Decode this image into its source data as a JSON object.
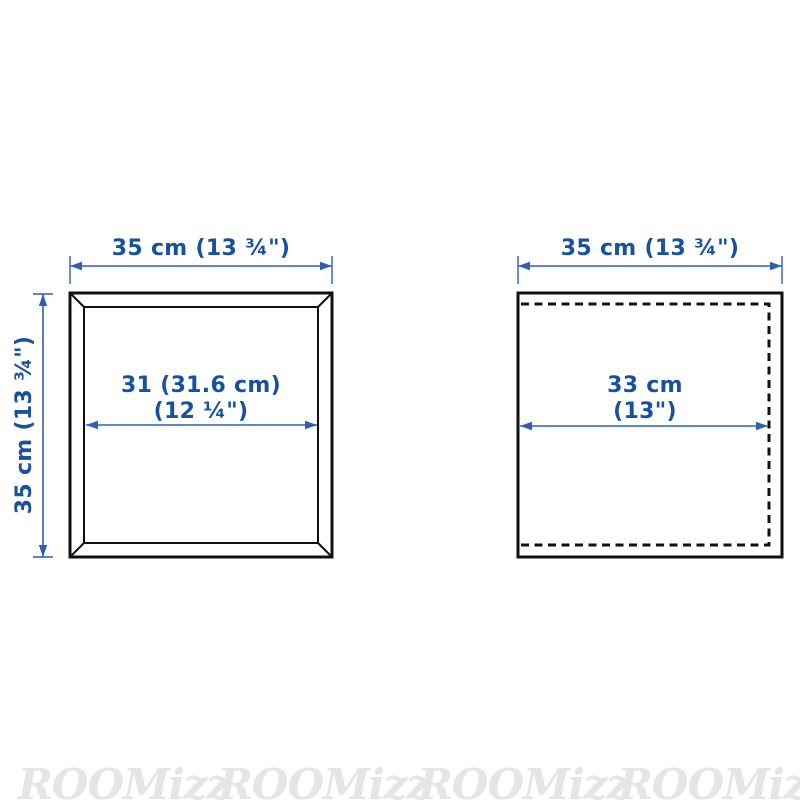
{
  "colors": {
    "dimension_text": "#17519f",
    "dimension_line": "#2f5fb3",
    "outline": "#111111",
    "watermark": "#e5e5e5"
  },
  "left_diagram": {
    "top_dimension": "35 cm (13 ¾\")",
    "height_dimension": "35 cm (13 ¾\")",
    "inner_width_line1": "31 (31.6 cm)",
    "inner_width_line2": "(12 ¼\")"
  },
  "right_diagram": {
    "top_dimension": "35 cm (13 ¾\")",
    "inner_width_line1": "33 cm",
    "inner_width_line2": "(13\")"
  },
  "watermark": {
    "text": "ROOMizz",
    "repeat": 4
  }
}
